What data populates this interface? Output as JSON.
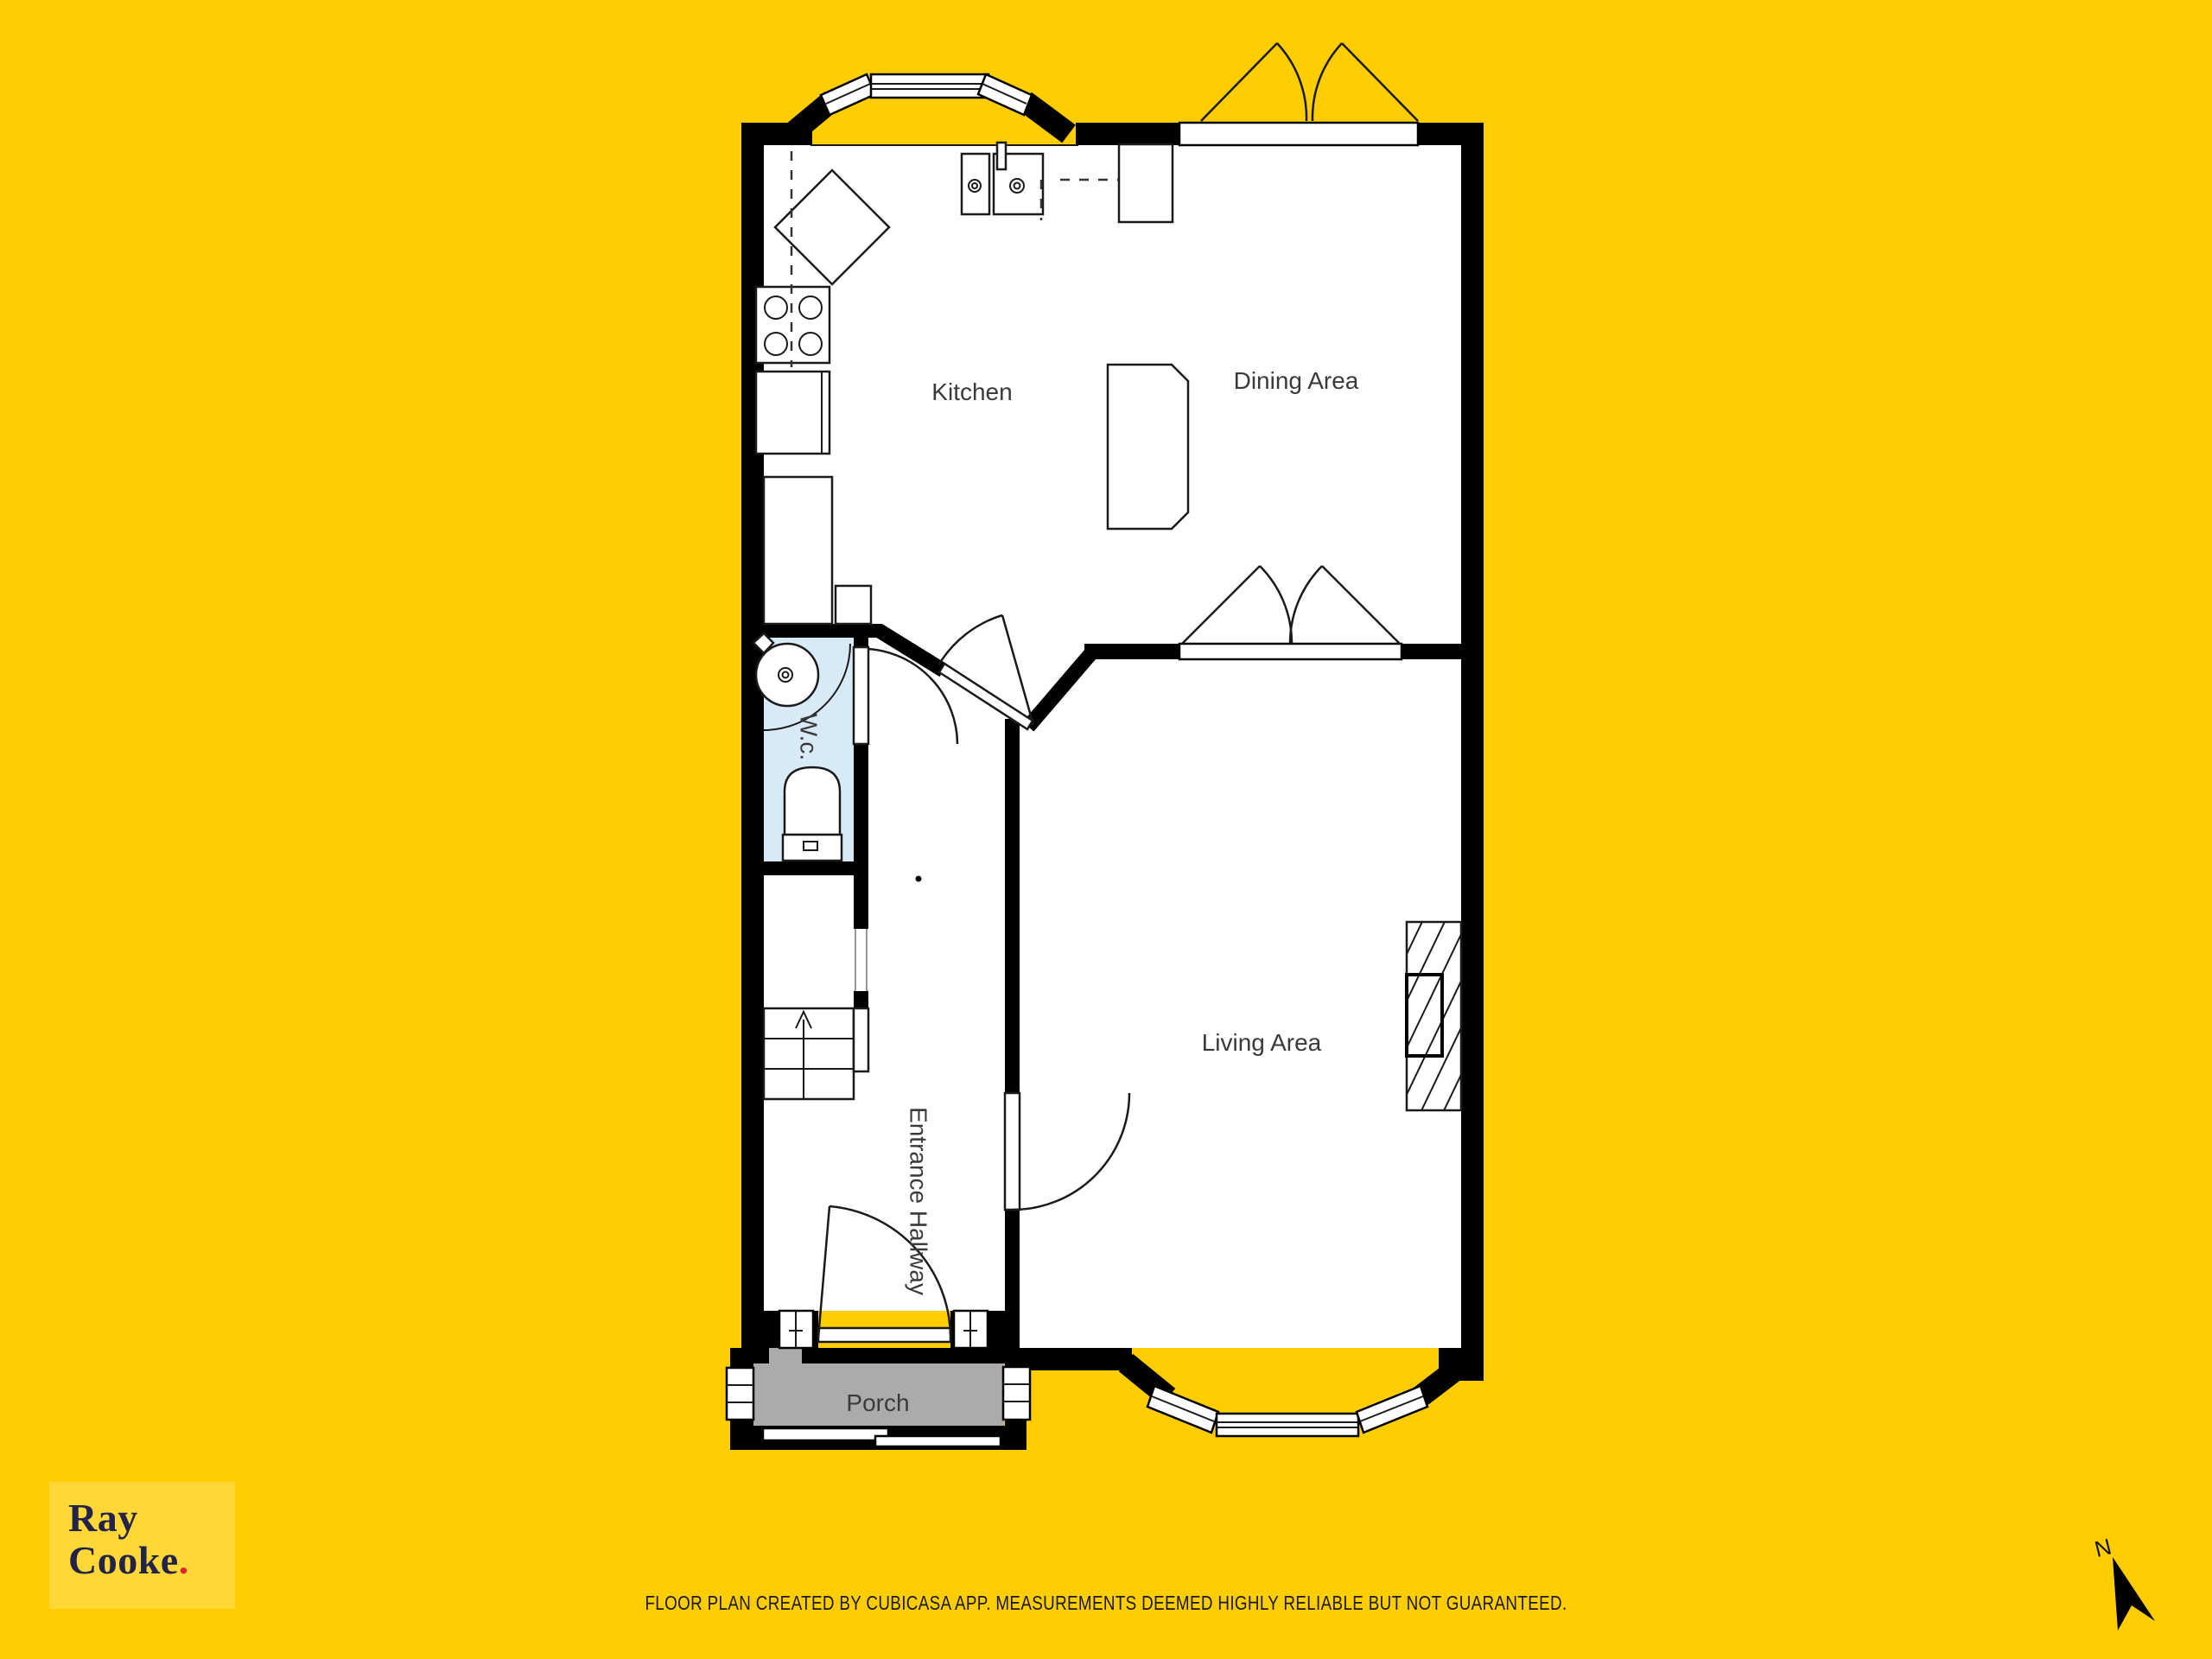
{
  "page": {
    "background_color": "#FFCD00",
    "type": "floor-plan-image"
  },
  "floor_plan": {
    "rooms": [
      {
        "id": "kitchen",
        "label": "Kitchen"
      },
      {
        "id": "dining",
        "label": "Dining Area"
      },
      {
        "id": "living",
        "label": "Living Area"
      },
      {
        "id": "wc",
        "label": "W.c."
      },
      {
        "id": "hallway",
        "label": "Entrance Hallway"
      },
      {
        "id": "porch",
        "label": "Porch"
      }
    ],
    "colors": {
      "wall": "#000000",
      "room_floor": "#FFFFFF",
      "wc_floor": "#D9EAF7",
      "porch_floor": "#ABABAB",
      "label_text": "#3A3A3A"
    },
    "features": [
      "bay-window-kitchen-top",
      "dining-casement-window",
      "double-doors-dining-living",
      "stove-4-burner",
      "double-sink",
      "corner-counter",
      "fridge-cabinet",
      "wc-basin",
      "wc-toilet",
      "stairs-up",
      "fireplace",
      "entrance-door",
      "bay-window-living-bottom",
      "porch-sliding-door",
      "porch-side-windows"
    ]
  },
  "branding": {
    "logo_line1": "Ray",
    "logo_line2": "Cooke",
    "logo_dot": ".",
    "logo_bg": "#FFDB3D",
    "logo_text_color": "#23234A",
    "logo_dot_color": "#D7272E"
  },
  "footer": {
    "disclaimer": "FLOOR PLAN CREATED BY CUBICASA APP. MEASUREMENTS DEEMED HIGHLY RELIABLE BUT NOT GUARANTEED."
  },
  "compass": {
    "label": "N"
  }
}
